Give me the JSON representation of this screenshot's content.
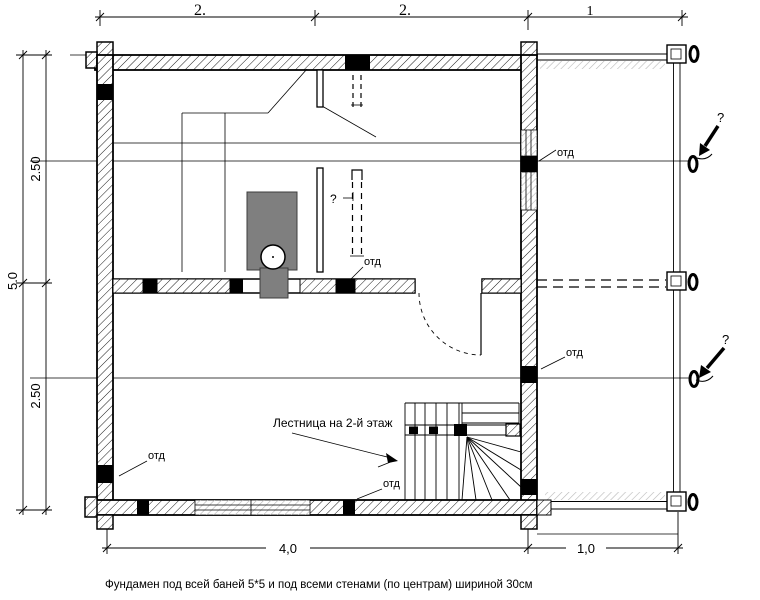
{
  "dimensions": {
    "top": {
      "seg1": "2.",
      "seg2": "2.",
      "seg3": "1"
    },
    "left": {
      "total": "5.0",
      "upper": "2.50",
      "lower": "2.50"
    },
    "bottom": {
      "main": "4,0",
      "porch": "1,0"
    }
  },
  "labels": {
    "otd": [
      "отд",
      "отд",
      "отд",
      "отд",
      "отд"
    ],
    "staircase": "Лестница на 2-й этаж",
    "question": [
      "?",
      "?",
      "?"
    ]
  },
  "footnote": "Фундамен под всей баней 5*5 и под всеми стенами (по центрам) шириной 30см",
  "colors": {
    "ink": "#000000",
    "stove_fill": "#7f7f7f",
    "background": "#ffffff",
    "light_hatch": "#b8b8b8"
  }
}
